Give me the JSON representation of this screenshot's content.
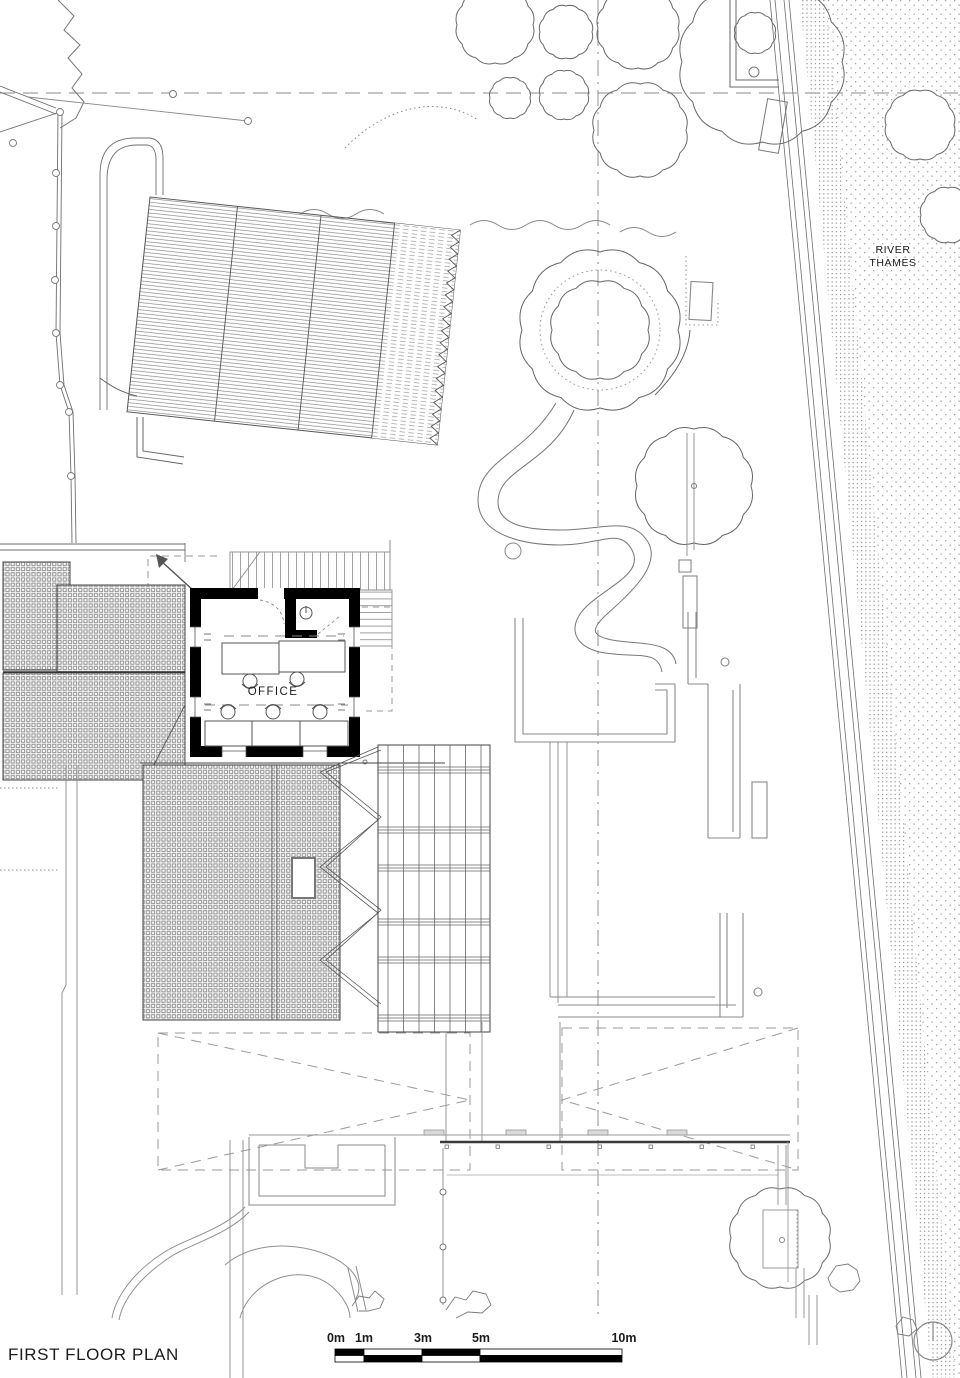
{
  "title": "FIRST FLOOR PLAN",
  "labels": {
    "river_line1": "RIVER",
    "river_line2": "THAMES",
    "office": "OFFICE"
  },
  "scale_bar": {
    "m0": "0m",
    "m1": "1m",
    "m3": "3m",
    "m5": "5m",
    "m10": "10m"
  },
  "icons": {
    "north": "north-indicator-icon",
    "entry_arrow": "entry-arrow-icon",
    "wc_fixture": "wc-fixture-icon"
  },
  "colors": {
    "ink": "#3f3f3f",
    "mid": "#6e6e6e",
    "light": "#a8a8a8",
    "poche": "#000000",
    "paper": "#ffffff"
  }
}
